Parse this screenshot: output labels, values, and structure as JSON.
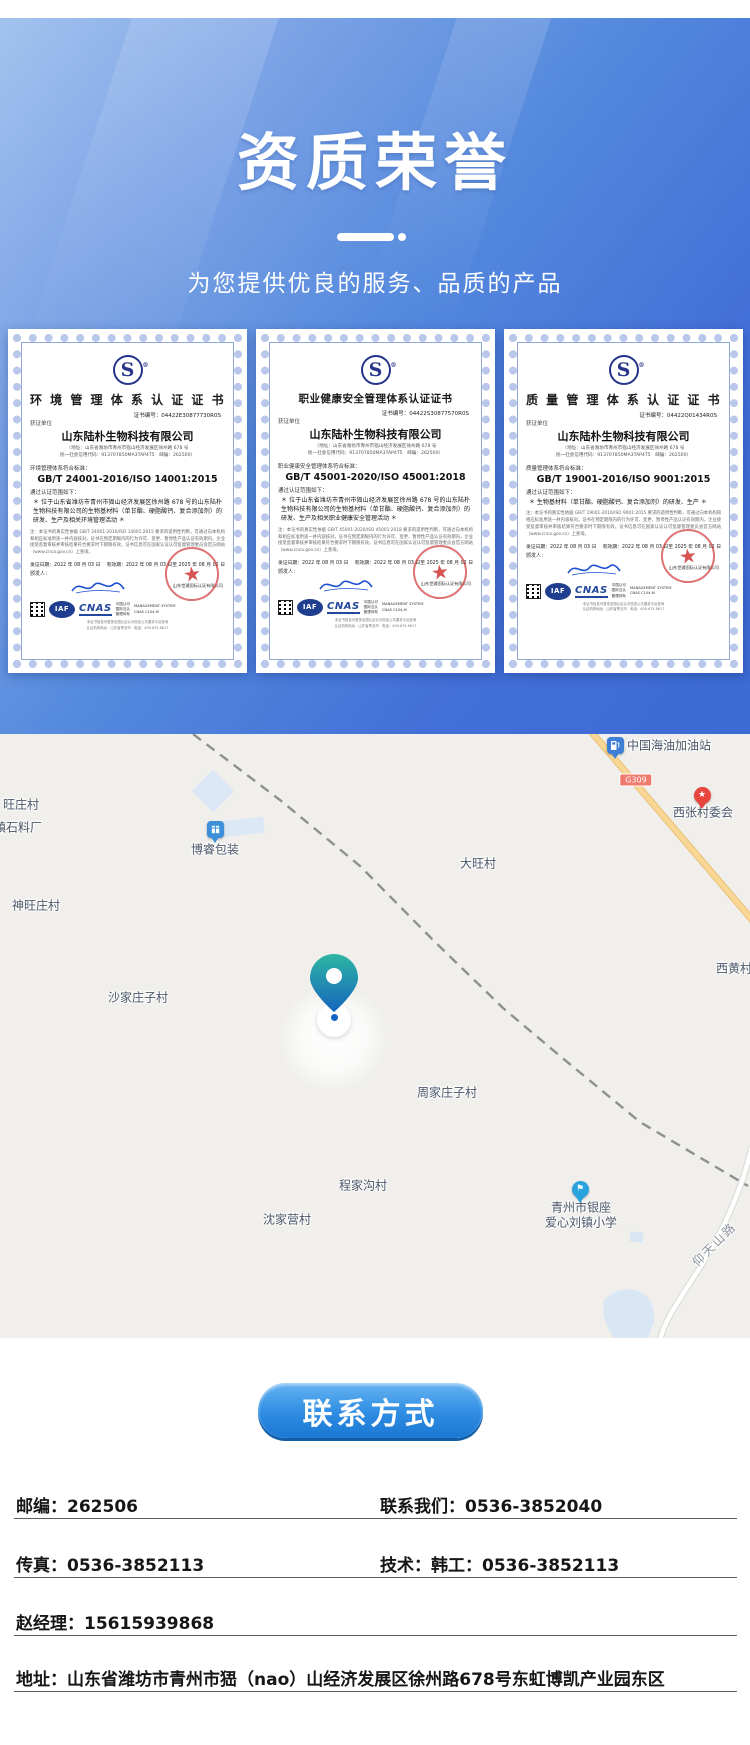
{
  "hero": {
    "title": "资质荣誉",
    "subtitle": "为您提供优良的服务、品质的产品",
    "accent_color": "#4a82da"
  },
  "certificates": [
    {
      "logo_letter": "S",
      "title": "环 境 管 理 体 系 认 证 证 书",
      "long_title": false,
      "cert_no": "证书编号：04422E30877730R0S",
      "unit_label": "获证单位",
      "company": "山东陆朴生物科技有限公司",
      "addr_lines": [
        "（地址：山东省潍坊市青州市峱山经济发展区徐州路 678 号",
        "统一社会信用代码：913707850MA3TAP4T5　邮编：262500）"
      ],
      "std_label": "环境管理体系符合标准：",
      "standard": "GB/T 24001-2016/ISO 14001:2015",
      "scope_label": "通过认证范围如下：",
      "scope": "＊ 位于山东省潍坊市青州市峱山经济发展区徐州路 678 号的山东陆朴生物科技有限公司的生物基材料（单甘酯、硬脂酸钙、复合添加剂）的研发、生产及相关环境管理活动 ＊",
      "legal": "注：本证书的真实性依据 GB/T 24001-2016/ISO 14001:2015 要求的适用性判断，可通过向本机构和相应标准用途一并内容核对。证书在预定期限内的行为许可、变更、暂停性产品认证有效期内，企业接受监督审核并审核结果符合要求时下期限有效。证书信息可在国家认证认可监督管理委员会官方网站（www.cnca.gov.cn）上查询。",
      "issue_date": "发证日期：2022 年 08 月 03 日",
      "valid_date": "有效期：2022 年 08 月 03 日至 2025 年 08 月 02 日",
      "issuer_label": "颁发人：",
      "issuer": "山东世通国际认证有限公司",
      "stamp_star": "★",
      "iaf": "IAF",
      "cnas": "CNAS",
      "cn_lines": [
        "中国认可",
        "国际互认",
        "管理体系"
      ],
      "ms_lines": [
        "MANAGEMENT SYSTEM",
        "CNAS C104-M"
      ],
      "footer_lines": [
        "本证书信息可登录全国认证认可信息公共服务平台查询",
        "认证机构地址：山东省青岛市　电话：400-675-8617"
      ]
    },
    {
      "logo_letter": "S",
      "title": "职业健康安全管理体系认证证书",
      "long_title": true,
      "cert_no": "证书编号：04422S30877570R0S",
      "unit_label": "获证单位",
      "company": "山东陆朴生物科技有限公司",
      "addr_lines": [
        "（地址：山东省潍坊市青州市峱山经济发展区徐州路 678 号",
        "统一社会信用代码：913707850MA3TAP4T5　邮编：262500）"
      ],
      "std_label": "职业健康安全管理体系符合标准：",
      "standard": "GB/T 45001-2020/ISO 45001:2018",
      "scope_label": "通过认证范围如下：",
      "scope": "＊ 位于山东省潍坊市青州市峱山经济发展区徐州路 678 号的山东陆朴生物科技有限公司的生物基材料（单甘酯、硬脂酸钙、复合添加剂）的研发、生产及相关职业健康安全管理活动 ＊",
      "legal": "注：本证书的真实性依据 GB/T 45001-2020/ISO 45001:2018 要求的适用性判断，可通过向本机构和相应标准用途一并内容核对。证书在预定期限内的行为许可、变更、暂停性产品认证有效期内，企业接受监督审核并审核结果符合要求时下期限有效。证书信息可在国家认证认可监督管理委员会官方网站（www.cnca.gov.cn）上查询。",
      "issue_date": "发证日期：2022 年 08 月 03 日",
      "valid_date": "有效期：2022 年 08 月 03 日至 2025 年 08 月 02 日",
      "issuer_label": "颁发人：",
      "issuer": "山东世通国际认证有限公司",
      "stamp_star": "★",
      "iaf": "IAF",
      "cnas": "CNAS",
      "cn_lines": [
        "中国认可",
        "国际互认",
        "管理体系"
      ],
      "ms_lines": [
        "MANAGEMENT SYSTEM",
        "CNAS C104-M"
      ],
      "footer_lines": [
        "本证书信息可登录全国认证认可信息公共服务平台查询",
        "认证机构地址：山东省青岛市　电话：400-675-8617"
      ]
    },
    {
      "logo_letter": "S",
      "title": "质 量 管 理 体 系 认 证 证 书",
      "long_title": false,
      "cert_no": "证书编号：04422Q01434R0S",
      "unit_label": "获证单位",
      "company": "山东陆朴生物科技有限公司",
      "addr_lines": [
        "（地址：山东省潍坊市青州市峱山经济发展区徐州路 678 号",
        "统一社会信用代码：913707850MA3TAP4T5　邮编：262500）"
      ],
      "std_label": "质量管理体系符合标准：",
      "standard": "GB/T 19001-2016/ISO 9001:2015",
      "scope_label": "通过认证范围如下：",
      "scope": "＊ 生物基材料（单甘酯、硬脂酸钙、复合添加剂）的研发、生产 ＊",
      "legal": "注：本证书的真实性依据 GB/T 19001-2016/ISO 9001:2015 要求的适用性判断，可通过向本机构和相应标准用途一并内容核对。证书在预定期限内的行为许可、变更、暂停性产品认证有效期内，企业接受监督审核并审核结果符合要求时下期限有效。证书信息可在国家认证认可监督管理委员会官方网站（www.cnca.gov.cn）上查询。",
      "issue_date": "发证日期：2022 年 08 月 03 日",
      "valid_date": "有效期：2022 年 08 月 03 日至 2025 年 08 月 02 日",
      "issuer_label": "颁发人：",
      "issuer": "山东世通国际认证有限公司",
      "stamp_star": "★",
      "iaf": "IAF",
      "cnas": "CNAS",
      "cn_lines": [
        "中国认可",
        "国际互认",
        "管理体系"
      ],
      "ms_lines": [
        "MANAGEMENT SYSTEM",
        "CNAS C104-M"
      ],
      "footer_lines": [
        "本证书信息可登录全国认证认可信息公共服务平台查询",
        "认证机构地址：山东省青岛市　电话：400-675-8617"
      ]
    }
  ],
  "map": {
    "g309_badge": {
      "text": "G309",
      "x": 636,
      "y": 46
    },
    "labels": [
      {
        "text": "中国海油加油站",
        "x": 627,
        "y": 11,
        "edge": true
      },
      {
        "text": "西张村委会",
        "x": 703,
        "y": 78
      },
      {
        "text": "大旺村",
        "x": 478,
        "y": 129
      },
      {
        "text": "西黄村",
        "x": 716,
        "y": 234,
        "edge": true
      },
      {
        "text": "旺庄村",
        "x": 21,
        "y": 70
      },
      {
        "text": "镇石料厂",
        "x": 18,
        "y": 93
      },
      {
        "text": "博睿包装",
        "x": 215,
        "y": 115
      },
      {
        "text": "神旺庄村",
        "x": 36,
        "y": 171
      },
      {
        "text": "沙家庄子村",
        "x": 138,
        "y": 263
      },
      {
        "text": "周家庄子村",
        "x": 447,
        "y": 358
      },
      {
        "text": "程家沟村",
        "x": 363,
        "y": 451
      },
      {
        "text": "沈家营村",
        "x": 287,
        "y": 485
      },
      {
        "text": "青州市银座",
        "x": 581,
        "y": 473
      },
      {
        "text": "爱心刘镇小学",
        "x": 581,
        "y": 488
      },
      {
        "text": "仰天山路",
        "x": 714,
        "y": 510,
        "rotate": -45,
        "muted": true
      }
    ],
    "pins": [
      {
        "kind": "gas-station",
        "x": 615,
        "y": 11,
        "color": "#3d7fd7"
      },
      {
        "kind": "committee-star",
        "x": 702,
        "y": 61,
        "color": "#e8453c",
        "glyph": "★"
      },
      {
        "kind": "package",
        "x": 215,
        "y": 95,
        "color": "#3d8fd9"
      },
      {
        "kind": "school-flag",
        "x": 580,
        "y": 455,
        "color": "#29a3dd",
        "glyph": "⚑"
      }
    ],
    "company_marker": {
      "x": 334,
      "y": 277
    }
  },
  "contact": {
    "button_label": "联系方式",
    "rows": [
      {
        "left": "邮编：262506",
        "right": "联系我们：0536-3852040"
      },
      {
        "left": "传真：0536-3852113",
        "right": "技术：韩工：0536-3852113"
      },
      {
        "left": "赵经理：15615939868",
        "right": ""
      },
      {
        "left": "地址：山东省潍坊市青州市峱（nao）山经济发展区徐州路678号东虹博凯产业园东区",
        "right": ""
      }
    ]
  }
}
